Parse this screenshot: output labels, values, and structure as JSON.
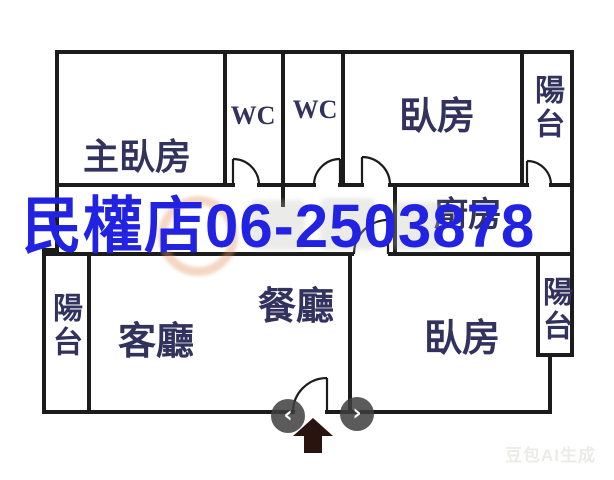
{
  "plan": {
    "labels": {
      "master_bedroom": "主臥房",
      "wc_1": "WC",
      "wc_2": "WC",
      "bedroom_top": "臥房",
      "balcony_top_right": "陽台",
      "kitchen": "廚房",
      "balcony_left": "陽台",
      "living_room": "客廳",
      "dining_room": "餐廳",
      "bedroom_bottom": "臥房",
      "balcony_bottom_right": "陽台"
    }
  },
  "overlay": {
    "caption": "民權店06-2503878"
  },
  "carousel": {
    "prev": "‹",
    "next": "›"
  },
  "ai_watermark": "豆包AI生成",
  "colors": {
    "wall": "#1c1c1c",
    "room_label": "#32325f",
    "overlay_blue": "#2122e2",
    "nav_circle": "#3e3e3e",
    "entrance_arrow": "#2a1410"
  }
}
